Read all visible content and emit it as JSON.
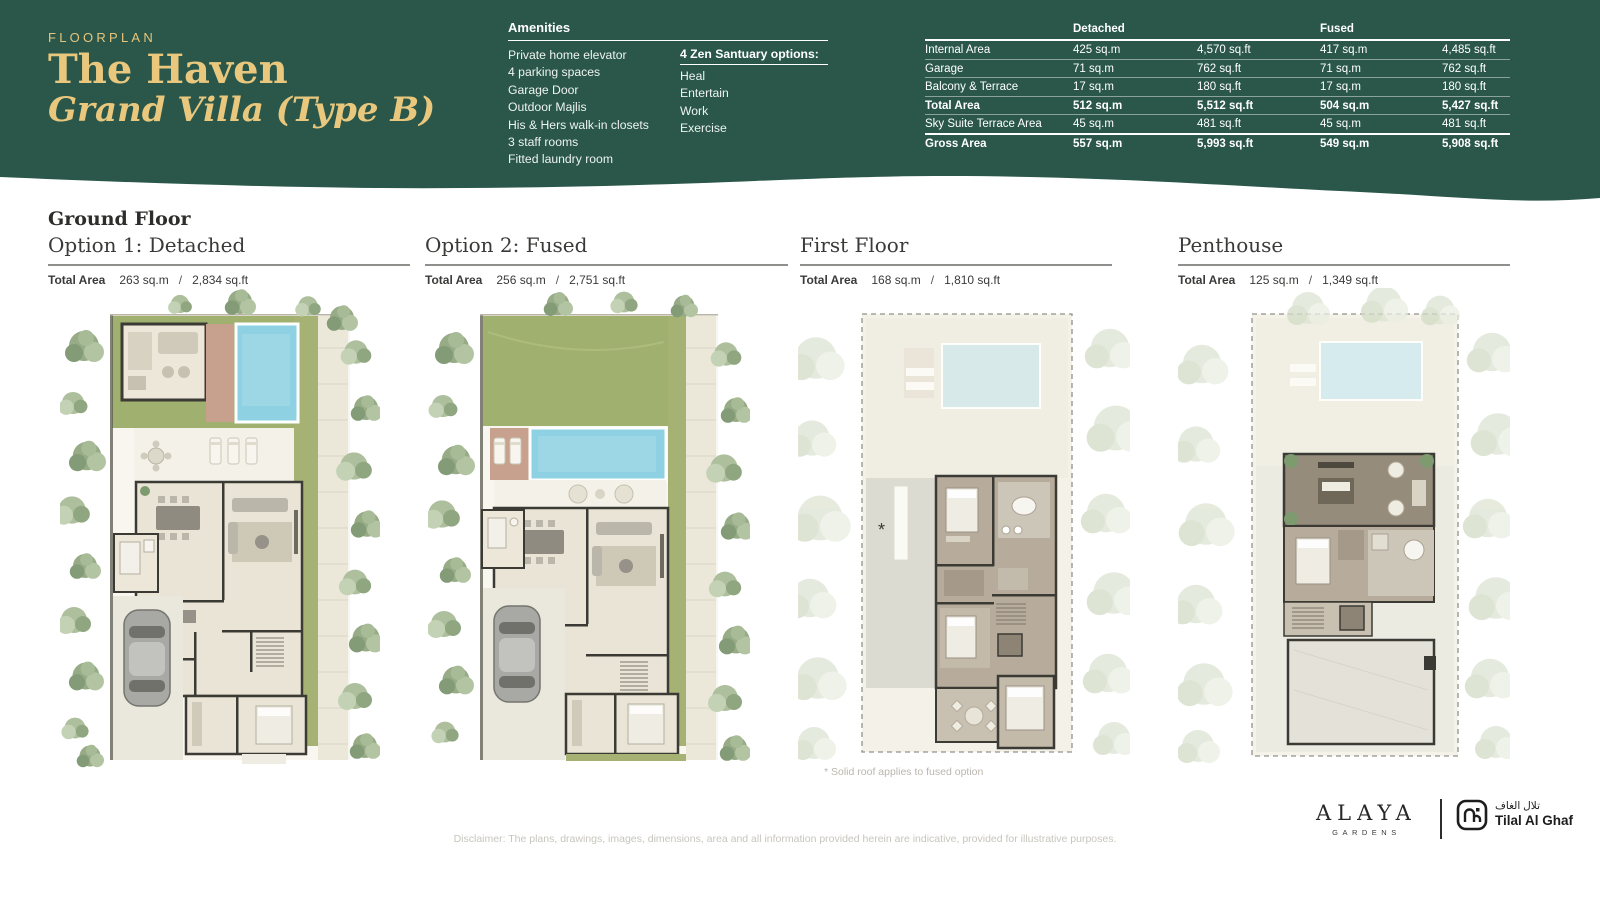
{
  "colors": {
    "header_green": "#2a574a",
    "gold": "#e9c87e",
    "pool_blue": "#8ed1e2",
    "lawn_green": "#9fb06f",
    "deck_brick": "#c7a18d",
    "house_cream": "#e9e4d5",
    "wall_dark": "#3b3a34"
  },
  "hero": {
    "eyebrow": "FLOORPLAN",
    "title_line1": "The Haven",
    "title_line2": "Grand Villa (Type B)"
  },
  "amenities": {
    "title": "Amenities",
    "items": [
      "Private home elevator",
      "4 parking spaces",
      "Garage Door",
      "Outdoor Majlis",
      "His & Hers walk-in closets",
      "3 staff rooms",
      "Fitted laundry room"
    ],
    "zen_title": "4 Zen Santuary options:",
    "zen_items": [
      "Heal",
      "Entertain",
      "Work",
      "Exercise"
    ]
  },
  "area_table": {
    "col_headers": [
      "Detached",
      "Fused"
    ],
    "rows": [
      {
        "label": "Internal Area",
        "values": [
          "425 sq.m",
          "4,570 sq.ft",
          "417 sq.m",
          "4,485 sq.ft"
        ]
      },
      {
        "label": "Garage",
        "values": [
          "71 sq.m",
          "762 sq.ft",
          "71 sq.m",
          "762 sq.ft"
        ]
      },
      {
        "label": "Balcony & Terrace",
        "values": [
          "17 sq.m",
          "180 sq.ft",
          "17 sq.m",
          "180 sq.ft"
        ]
      },
      {
        "label": "Total Area",
        "values": [
          "512 sq.m",
          "5,512 sq.ft",
          "504 sq.m",
          "5,427 sq.ft"
        ]
      },
      {
        "label": "Sky Suite Terrace Area",
        "values": [
          "45 sq.m",
          "481 sq.ft",
          "45 sq.m",
          "481 sq.ft"
        ]
      },
      {
        "label": "Gross Area",
        "values": [
          "557 sq.m",
          "5,993 sq.ft",
          "549 sq.m",
          "5,908 sq.ft"
        ]
      }
    ]
  },
  "plans": {
    "ground_floor_heading": "Ground Floor",
    "columns": [
      {
        "title": "Option 1: Detached",
        "total_area_label": "Total Area",
        "sqm": "263 sq.m",
        "sep": "/",
        "sqft": "2,834 sq.ft"
      },
      {
        "title": "Option 2: Fused",
        "total_area_label": "Total Area",
        "sqm": "256 sq.m",
        "sep": "/",
        "sqft": "2,751 sq.ft"
      },
      {
        "title": "First Floor",
        "total_area_label": "Total Area",
        "sqm": "168 sq.m",
        "sep": "/",
        "sqft": "1,810 sq.ft"
      },
      {
        "title": "Penthouse",
        "total_area_label": "Total Area",
        "sqm": "125 sq.m",
        "sep": "/",
        "sqft": "1,349 sq.ft"
      }
    ],
    "roof_note_marker": "*",
    "footnote": "* Solid roof applies to fused option"
  },
  "footer": {
    "disclaimer": "Disclaimer: The plans, drawings, images, dimensions, area and all information provided herein are indicative, provided for illustrative purposes.",
    "alaya_name": "ALAYA",
    "alaya_sub": "GARDENS",
    "partner_arabic": "تلال الغاف",
    "partner_name": "Tilal Al Ghaf"
  }
}
